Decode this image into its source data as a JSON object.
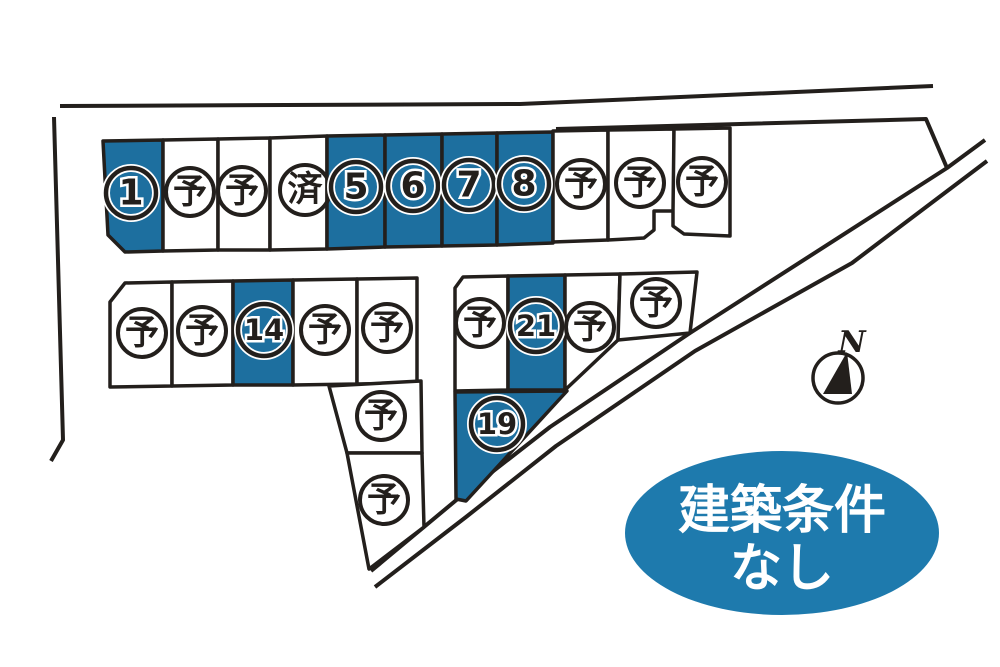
{
  "colors": {
    "lot_highlight_blue": "#1d6f9f",
    "annotation_blue": "#1e7aad",
    "line_dark": "#231f1c",
    "lot_white": "#ffffff"
  },
  "lots": [
    {
      "label": "1",
      "status": "highlighted",
      "fill": "#1d6f9f"
    },
    {
      "label": "予",
      "status": "reserved",
      "fill": "#ffffff"
    },
    {
      "label": "予",
      "status": "reserved",
      "fill": "#ffffff"
    },
    {
      "label": "済",
      "status": "sold",
      "fill": "#ffffff"
    },
    {
      "label": "5",
      "status": "highlighted",
      "fill": "#1d6f9f"
    },
    {
      "label": "6",
      "status": "highlighted",
      "fill": "#1d6f9f"
    },
    {
      "label": "7",
      "status": "highlighted",
      "fill": "#1d6f9f"
    },
    {
      "label": "8",
      "status": "highlighted",
      "fill": "#1d6f9f"
    },
    {
      "label": "予",
      "status": "reserved",
      "fill": "#ffffff"
    },
    {
      "label": "予",
      "status": "reserved",
      "fill": "#ffffff"
    },
    {
      "label": "予",
      "status": "reserved",
      "fill": "#ffffff"
    },
    {
      "label": "予",
      "status": "reserved",
      "fill": "#ffffff"
    },
    {
      "label": "予",
      "status": "reserved",
      "fill": "#ffffff"
    },
    {
      "label": "14",
      "status": "highlighted",
      "fill": "#1d6f9f"
    },
    {
      "label": "予",
      "status": "reserved",
      "fill": "#ffffff"
    },
    {
      "label": "予",
      "status": "reserved",
      "fill": "#ffffff"
    },
    {
      "label": "予",
      "status": "reserved",
      "fill": "#ffffff"
    },
    {
      "label": "予",
      "status": "reserved",
      "fill": "#ffffff"
    },
    {
      "label": "予",
      "status": "reserved",
      "fill": "#ffffff"
    },
    {
      "label": "21",
      "status": "highlighted",
      "fill": "#1d6f9f"
    },
    {
      "label": "予",
      "status": "reserved",
      "fill": "#ffffff"
    },
    {
      "label": "予",
      "status": "reserved",
      "fill": "#ffffff"
    },
    {
      "label": "19",
      "status": "highlighted",
      "fill": "#1d6f9f"
    }
  ],
  "annotation": {
    "line1": "建築条件",
    "line2": "なし",
    "fill": "#1e7aad"
  },
  "compass": {
    "label": "N"
  }
}
